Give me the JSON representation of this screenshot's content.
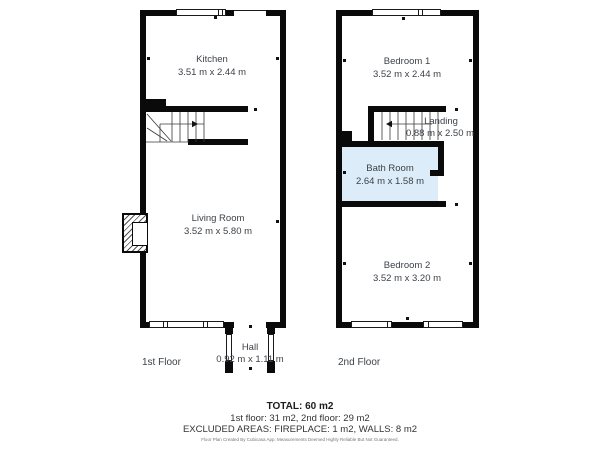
{
  "floors": [
    {
      "label": "1st Floor",
      "rooms": [
        {
          "name": "Kitchen",
          "dims": "3.51 m x 2.44 m"
        },
        {
          "name": "Living Room",
          "dims": "3.52 m x 5.80 m"
        },
        {
          "name": "Hall",
          "dims": "0.92 m x 1.11 m"
        }
      ]
    },
    {
      "label": "2nd Floor",
      "rooms": [
        {
          "name": "Bedroom 1",
          "dims": "3.52 m x 2.44 m"
        },
        {
          "name": "Landing",
          "dims": "0.88 m x 2.50 m"
        },
        {
          "name": "Bath Room",
          "dims": "2.64 m x 1.58 m"
        },
        {
          "name": "Bedroom 2",
          "dims": "3.52 m x 3.20 m"
        }
      ]
    }
  ],
  "summary": {
    "total": "TOTAL: 60 m2",
    "floors_line": "1st floor: 31 m2, 2nd floor: 29 m2",
    "excluded_line": "EXCLUDED AREAS: FIREPLACE: 1 m2, WALLS: 8 m2",
    "disclaimer": "Floor Plan Created By Cubicasa App. Measurements Deemed Highly Reliable But Not Guaranteed."
  },
  "colors": {
    "wall": "#0a0a0a",
    "bathroom_fill": "#dcecf8",
    "label_text": "#3d4248"
  }
}
